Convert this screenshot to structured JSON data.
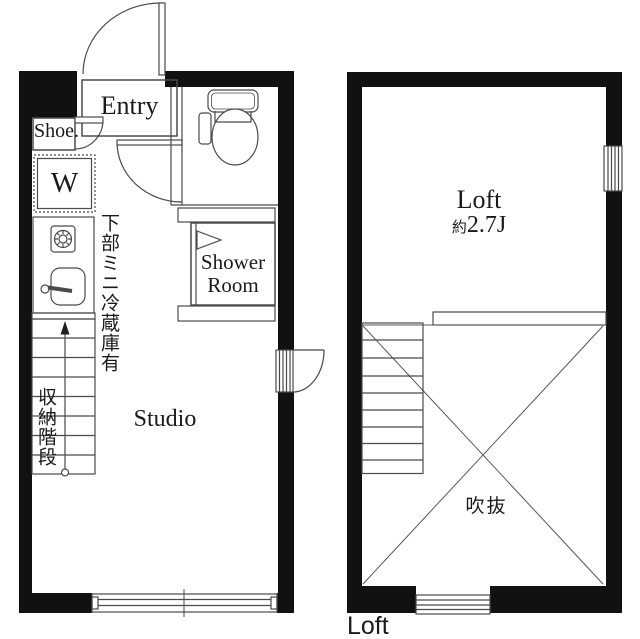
{
  "document_type": "apartment floor plan",
  "colors": {
    "background": "#ffffff",
    "wall": "#111111",
    "line": "#4a4a4a",
    "diagonal": "#555555",
    "text": "#1a1a1a"
  },
  "studio_floor": {
    "entry_label": "Entry",
    "shoe_cabinet_label": "Shoe.",
    "washer_label": "W",
    "shower_room_label": "Shower Room",
    "studio_label": "Studio",
    "fridge_note": "下部ミニ冷蔵庫有",
    "storage_stairs_note": "収納階段"
  },
  "loft_floor": {
    "loft_label": "Loft",
    "size_prefix": "約",
    "size_value": "2.7J",
    "void_label": "吹抜",
    "floor_caption": "Loft"
  }
}
